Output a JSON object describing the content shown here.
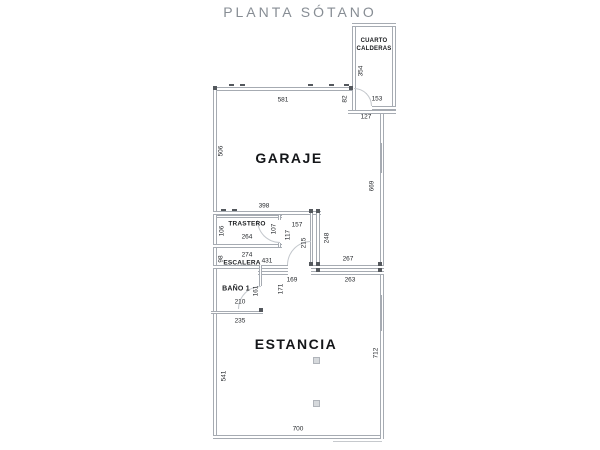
{
  "title": "PLANTA SÓTANO",
  "rooms": {
    "calderas1": "CUARTO",
    "calderas2": "CALDERAS",
    "garaje": "GARAJE",
    "trastero": "TRASTERO",
    "escalera": "ESCALERA",
    "bano": "BAÑO 1",
    "estancia": "ESTANCIA"
  },
  "dims": {
    "calderas_height": "354",
    "calderas_door": "153",
    "calderas_bottom": "127",
    "gap_right": "82",
    "garage_top": "581",
    "garage_left": "506",
    "garage_right": "669",
    "block_top": "398",
    "trastero_left": "106",
    "trastero_width": "264",
    "trastero_right": "107",
    "corridor_width": "157",
    "corridor_wall": "117",
    "corridor_height": "215",
    "passage_height": "248",
    "escalera_left": "98",
    "escalera_width": "274",
    "escalera_length": "431",
    "garage_lower_width": "267",
    "hall_left_width": "169",
    "hall_right_width": "263",
    "bano_height": "161",
    "bano_width": "210",
    "bano_wall_height": "171",
    "bano_bottom_width": "235",
    "estancia_left": "541",
    "estancia_right": "712",
    "estancia_bottom": "700"
  },
  "colors": {
    "wall": "#a6abb2",
    "dimension_text": "#26292d",
    "room_text": "#141619",
    "title_text": "#878d94",
    "node": "#54585d",
    "background": "#ffffff"
  }
}
